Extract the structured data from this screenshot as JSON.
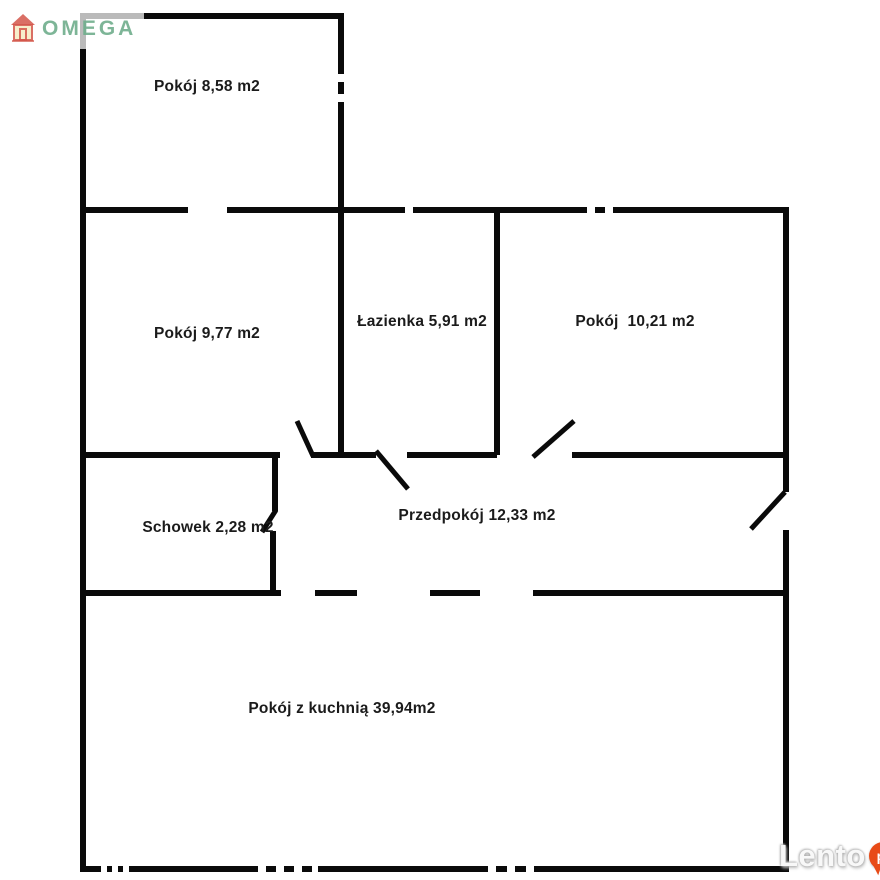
{
  "page": {
    "background_color": "#ffffff"
  },
  "branding": {
    "logo_text": "OMEGA",
    "logo_color": "#6fae8c"
  },
  "watermark": {
    "text": "Lento",
    "badge_text": "pl",
    "badge_color": "#e84b17"
  },
  "floorplan": {
    "wall_color": "#0a0a0a",
    "units": "m2",
    "rooms": [
      {
        "name": "Pokój",
        "area_m2": "8,58",
        "label": "Pokój 8,58 m2"
      },
      {
        "name": "Pokój",
        "area_m2": "9,77",
        "label": "Pokój 9,77 m2"
      },
      {
        "name": "Łazienka",
        "area_m2": "5,91",
        "label": "Łazienka 5,91 m2"
      },
      {
        "name": "Pokój",
        "area_m2": "10,21",
        "label": "Pokój  10,21 m2"
      },
      {
        "name": "Schowek",
        "area_m2": "2,28",
        "label": "Schowek 2,28 m2"
      },
      {
        "name": "Przedpokój",
        "area_m2": "12,33",
        "label": "Przedpokój 12,33 m2"
      },
      {
        "name": "Pokój z kuchnią",
        "area_m2": "39,94",
        "label": "Pokój z kuchnią 39,94m2"
      }
    ]
  }
}
